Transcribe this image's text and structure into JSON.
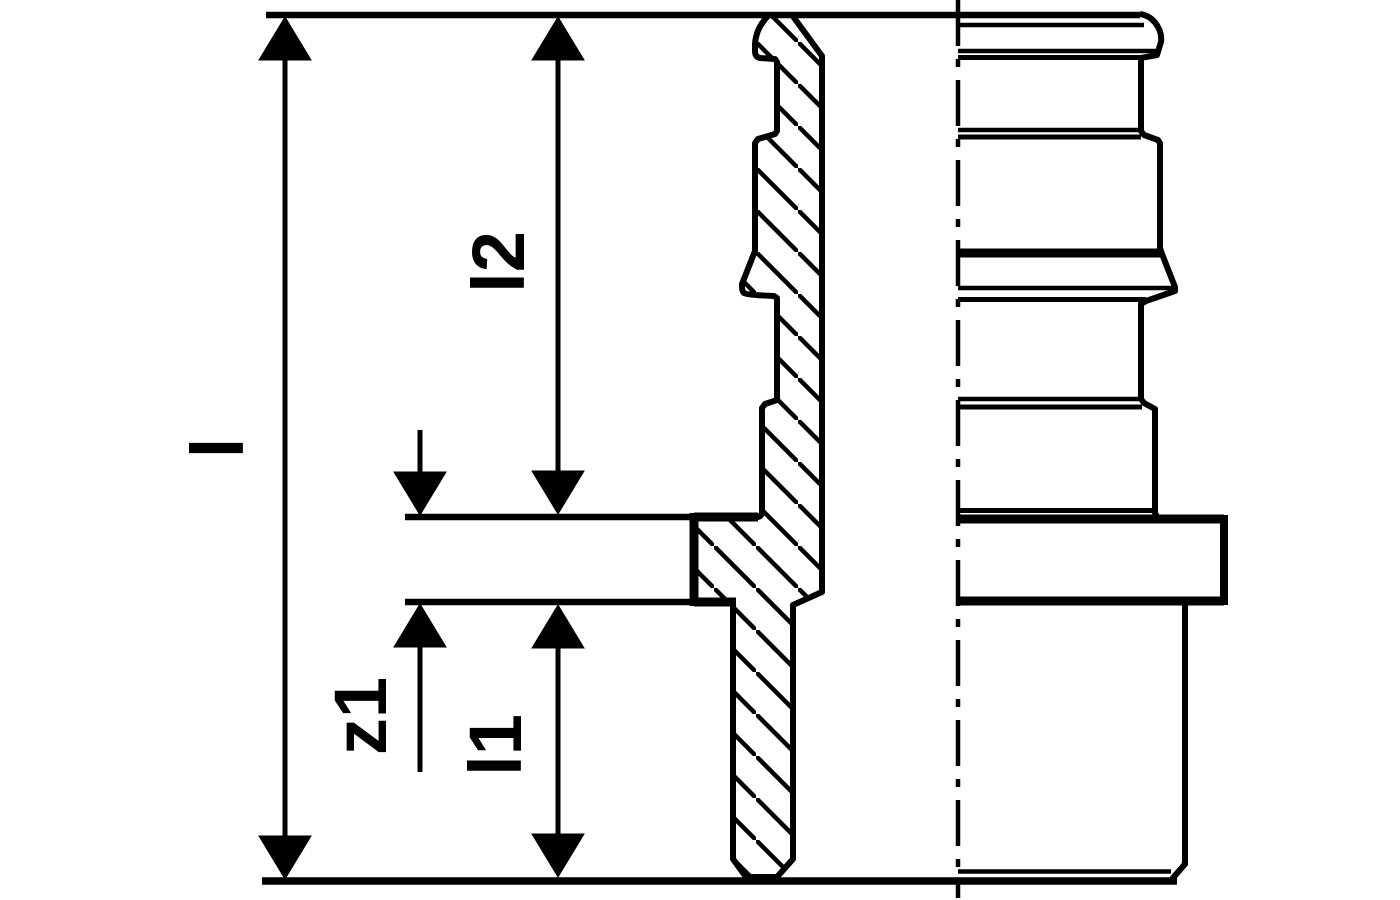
{
  "drawing": {
    "kind": "technical-section-drawing-of-pipe-fitting",
    "colors": {
      "ink": "#000000",
      "paper": "#ffffff"
    }
  },
  "labels": {
    "l": "l",
    "l2": "l2",
    "z1": "z1",
    "l1": "l1"
  }
}
